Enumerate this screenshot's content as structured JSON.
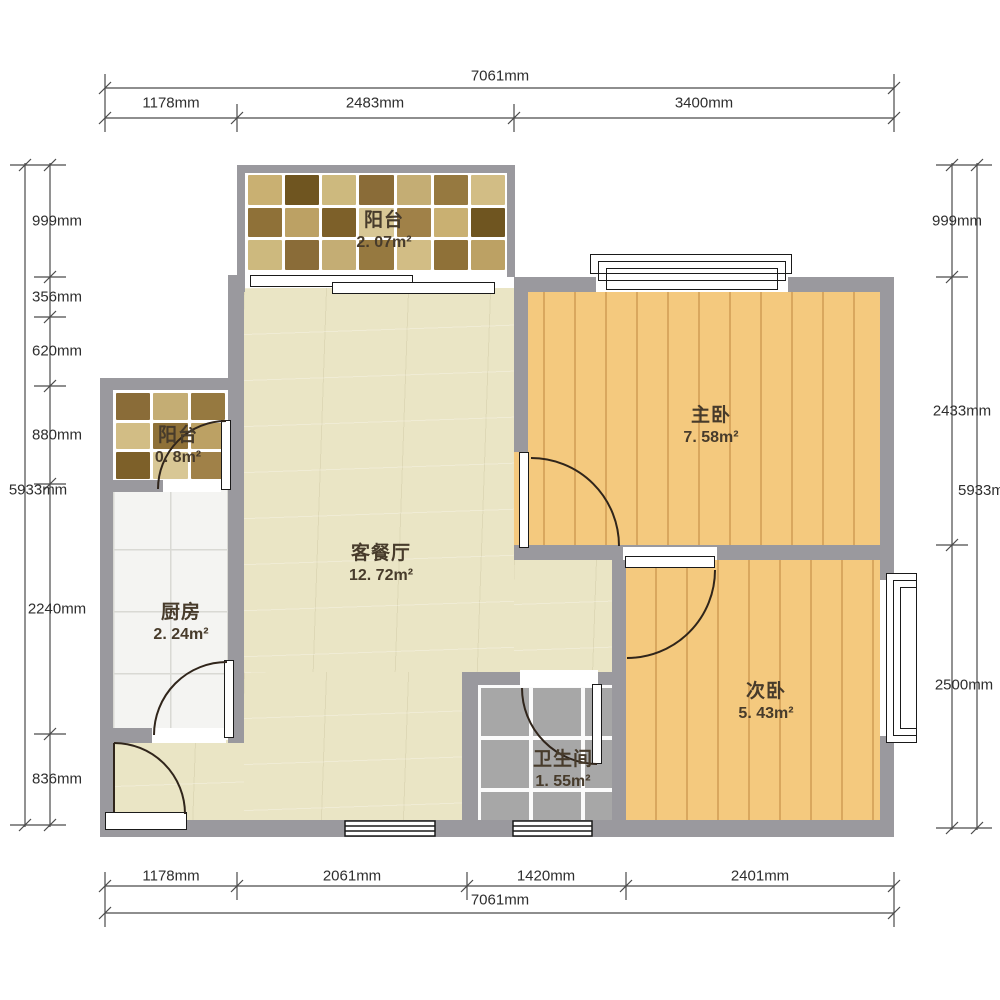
{
  "title": "两室户型图 (2-bedroom floor plan)",
  "dimensions": {
    "top": {
      "total": "7061mm",
      "segments": [
        "1178mm",
        "2483mm",
        "3400mm"
      ]
    },
    "bottom": {
      "total": "7061mm",
      "segments": [
        "1178mm",
        "2061mm",
        "1420mm",
        "2401mm"
      ]
    },
    "left": {
      "total": "5933mm",
      "segments": [
        "999mm",
        "356mm",
        "620mm",
        "880mm",
        "2240mm",
        "836mm"
      ]
    },
    "right": {
      "total": "5933mm",
      "segments": [
        "999mm",
        "2433mm",
        "2500mm"
      ]
    }
  },
  "rooms": {
    "balcony_top": {
      "name": "阳台",
      "area": "2. 07m²"
    },
    "balcony_left": {
      "name": "阳台",
      "area": "0. 8m²"
    },
    "living": {
      "name": "客餐厅",
      "area": "12. 72m²"
    },
    "kitchen": {
      "name": "厨房",
      "area": "2. 24m²"
    },
    "bath": {
      "name": "卫生间",
      "area": "1. 55m²"
    },
    "master": {
      "name": "主卧",
      "area": "7. 58m²"
    },
    "second": {
      "name": "次卧",
      "area": "5. 43m²"
    }
  },
  "colors": {
    "wall": "#9a999e",
    "living_floor": "#eae5c5",
    "bedroom_floor": "#f4c97e",
    "bedroom_plank_line": "#d9a75e",
    "kitchen_floor": "#f4f4f2",
    "bath_tile": "#a7a7a7",
    "bath_grout": "#fbfbfb",
    "dimension_line": "#4a4a4a",
    "door_arc": "#30251b",
    "label_text": "#473b2b"
  },
  "mosaic_palette": [
    "#c9b072",
    "#967940",
    "#d8c795",
    "#8a6c38",
    "#bca164",
    "#6f5520",
    "#d2bd85",
    "#a08148",
    "#c4ad74",
    "#7d6029",
    "#cdb97e",
    "#8f7138"
  ]
}
